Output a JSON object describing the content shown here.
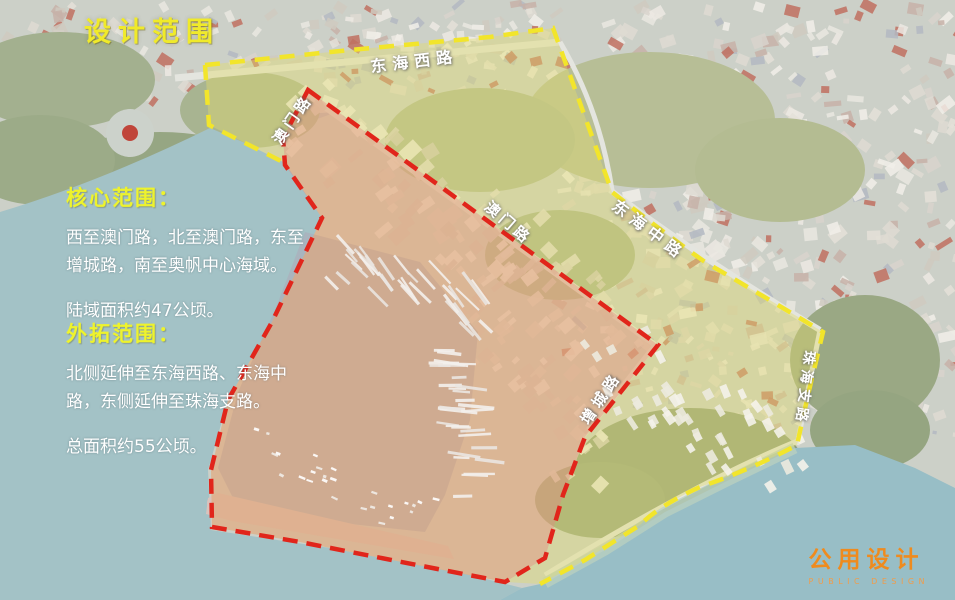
{
  "title": "设计范围",
  "legend": {
    "core": {
      "heading": "核心范围：",
      "body": "西至澳门路，北至澳门路，东至增城路，南至奥帆中心海域。",
      "area": "陆域面积约47公顷。"
    },
    "outer": {
      "heading": "外拓范围：",
      "body": "北侧延伸至东海西路、东海中路，东侧延伸至珠海支路。",
      "area": "总面积约55公顷。"
    }
  },
  "road_labels": {
    "donghai_west": "东海西路",
    "aomen_1": "澳门路",
    "aomen_2": "澳门路",
    "donghai_mid": "东海中路",
    "zengcheng": "增城路",
    "zhuhai_branch": "珠海支路"
  },
  "logo": {
    "cn": "公用设计",
    "en": "PUBLIC DESIGN"
  },
  "colors": {
    "core_boundary_red": "#e1251b",
    "outer_boundary_yellow": "#f2e52b",
    "core_fill_pink": "rgba(228,136,130,0.40)",
    "outer_fill_yellow": "rgba(226,220,110,0.42)",
    "title_yellow": "#f0ea2a",
    "logo_orange": "#ef8b1e",
    "sea_teal": "#a3c2c6"
  }
}
